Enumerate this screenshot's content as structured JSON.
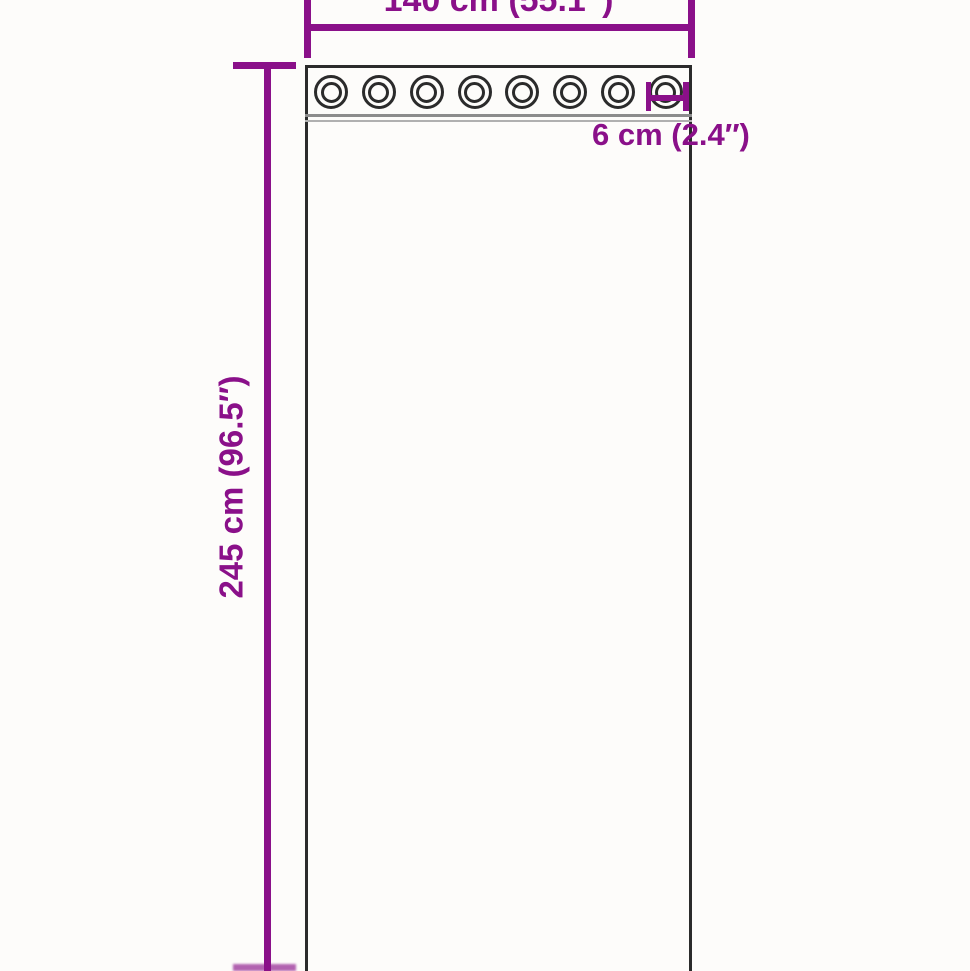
{
  "diagram": {
    "width_label": "140 cm (55.1″)",
    "height_label": "245 cm (96.5″)",
    "grommet_diameter_label": "6 cm (2.4″)",
    "grommet_count": 8
  },
  "colors": {
    "dimension": "#8a1089",
    "outline": "#2b2b2b",
    "separator_dark": "#8c8c8c",
    "separator_light": "#b0b0b0",
    "background": "#fdfcfa"
  }
}
